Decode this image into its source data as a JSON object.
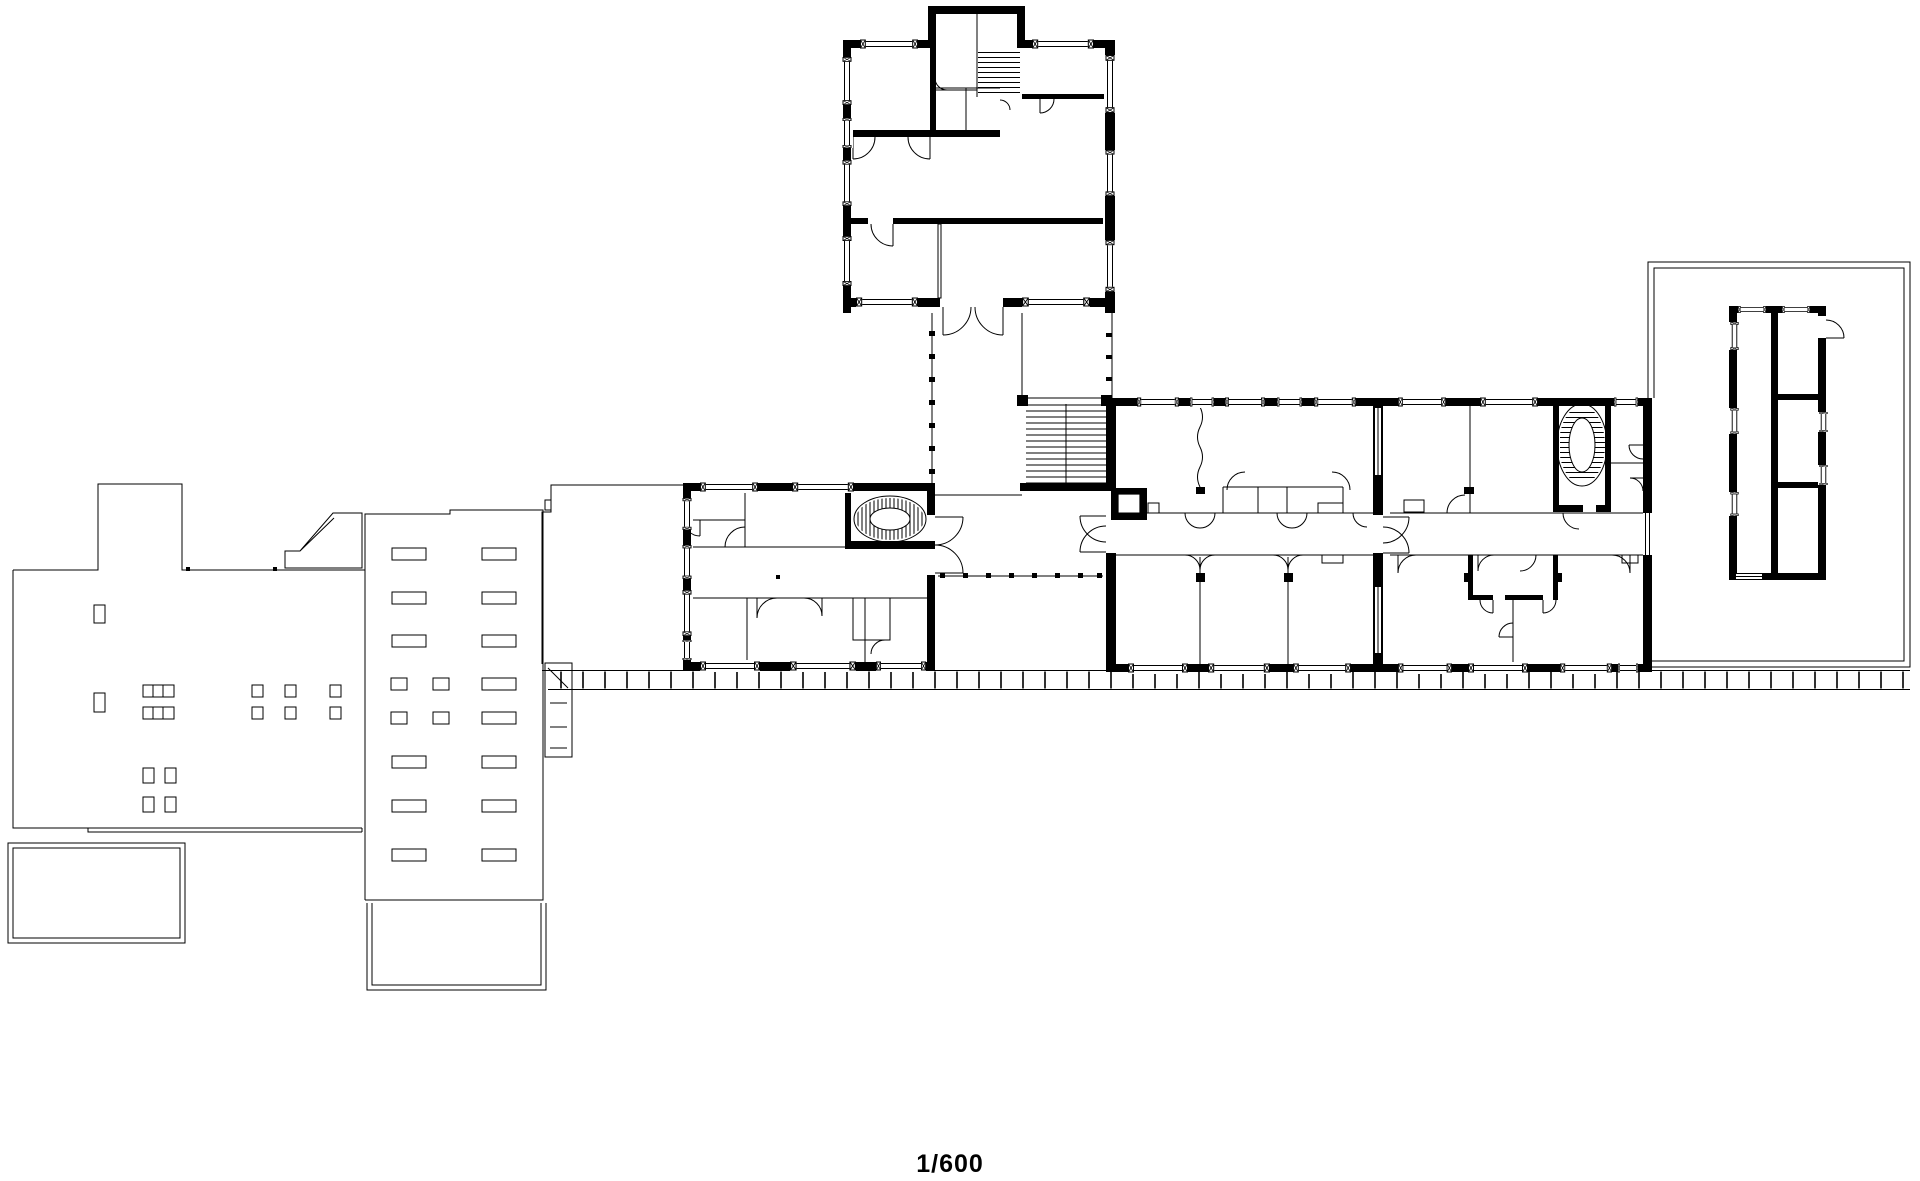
{
  "paper": "#ffffff",
  "ink": "#000000",
  "scale_label": "1/600",
  "drawing": {
    "type": "architectural-floor-plan",
    "elements": [
      "north-pavilion",
      "roof-stair-shaft",
      "link-corridor",
      "main-staircase",
      "west-classroom-block",
      "oval-staircase-west",
      "junction-hall",
      "central-classroom-block",
      "elevator",
      "east-classroom-block",
      "oval-staircase-east",
      "south-colonnade-walkway",
      "west-terrace",
      "existing-west-building",
      "rooflight-building",
      "access-ramp",
      "annex-rectangle",
      "u-shaped-structure",
      "east-courtyard",
      "courtyard-outbuilding",
      "scale-label"
    ]
  }
}
